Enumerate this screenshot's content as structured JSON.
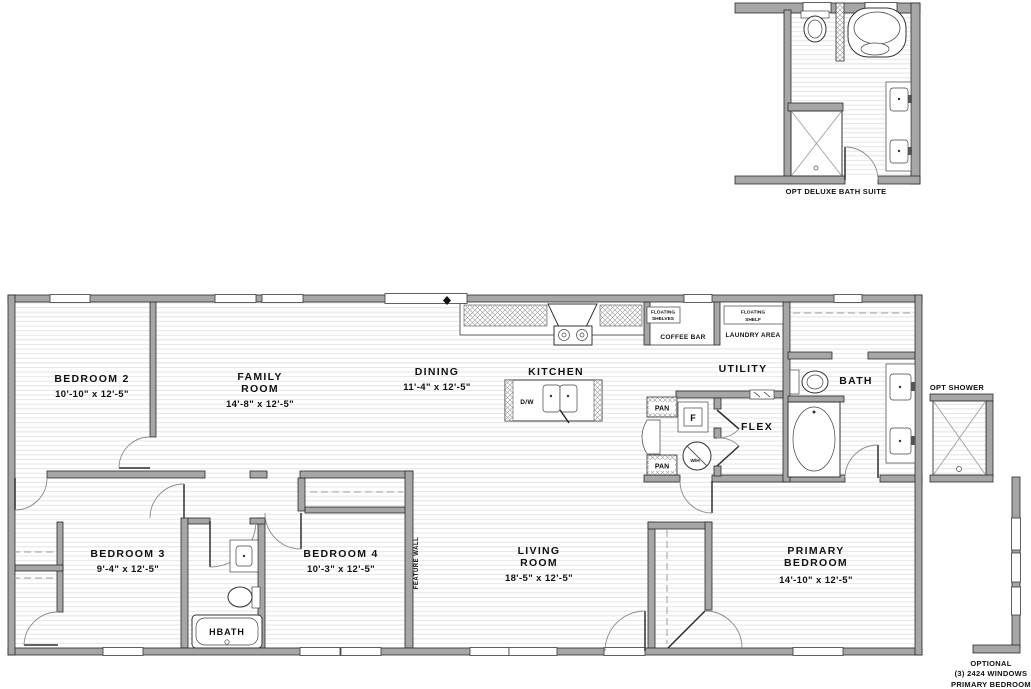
{
  "plan": {
    "rooms": {
      "bedroom2": {
        "name": "BEDROOM 2",
        "dims": "10'-10\" x 12'-5\""
      },
      "family_room": {
        "line1": "FAMILY",
        "line2": "ROOM",
        "dims": "14'-8\" x 12'-5\""
      },
      "dining": {
        "name": "DINING",
        "dims": "11'-4\" x 12'-5\""
      },
      "kitchen": {
        "name": "KITCHEN"
      },
      "utility": {
        "name": "UTILITY"
      },
      "flex": {
        "name": "FLEX"
      },
      "bath": {
        "name": "BATH"
      },
      "bedroom3": {
        "name": "BEDROOM 3",
        "dims": "9'-4\" x 12'-5\""
      },
      "hbath": {
        "name": "HBATH"
      },
      "bedroom4": {
        "name": "BEDROOM 4",
        "dims": "10'-3\" x 12'-5\""
      },
      "living_room": {
        "line1": "LIVING",
        "line2": "ROOM",
        "dims": "18'-5\" x 12'-5\""
      },
      "primary_bedroom": {
        "line1": "PRIMARY",
        "line2": "BEDROOM",
        "dims": "14'-10\" x 12'-5\""
      }
    },
    "features": {
      "floating_shelves_line1": "FLOATING",
      "floating_shelves_line2": "SHELVES",
      "coffee_bar": "COFFEE BAR",
      "floating_shelf_line1": "FLOATING",
      "floating_shelf_line2": "SHELF",
      "laundry_area": "LAUNDRY AREA",
      "pantry_upper": "PAN",
      "pantry_lower": "PAN",
      "furnace": "F",
      "water_heater": "W/H",
      "dishwasher": "D/W",
      "feature_wall": "FEATURE WALL"
    },
    "callouts": {
      "deluxe_bath_caption": "OPT DELUXE BATH SUITE",
      "opt_shower_caption": "OPT SHOWER",
      "optional_windows_line1": "OPTIONAL",
      "optional_windows_line2": "(3) 2424 WINDOWS",
      "optional_windows_line3": "PRIMARY BEDROOM"
    }
  }
}
